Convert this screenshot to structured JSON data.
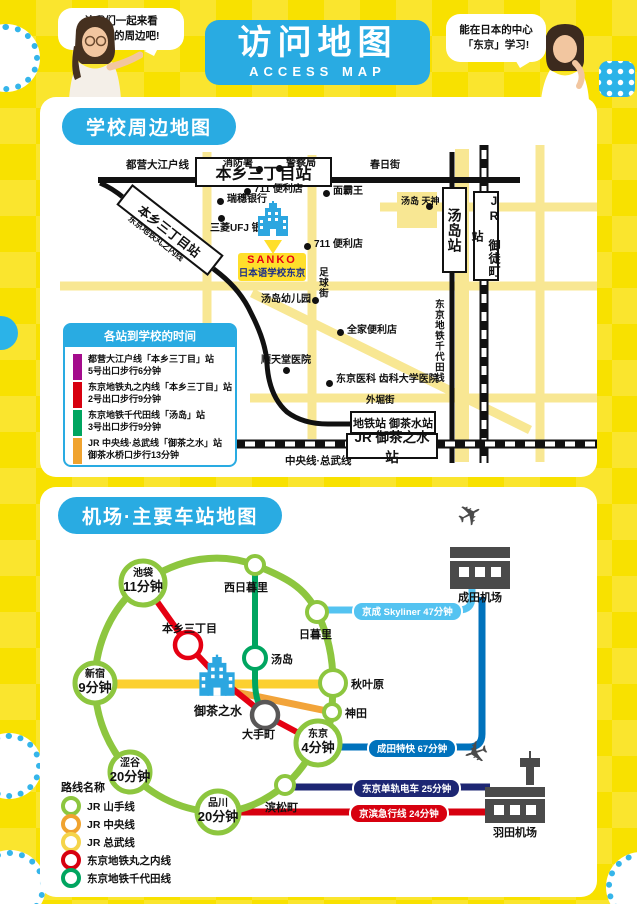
{
  "page": {
    "bg_color": "#f8e100",
    "accent_color": "#29abe2"
  },
  "header": {
    "title": "访问地图",
    "subtitle": "ACCESS MAP",
    "bubble_left": "让我们一起来看\n看学校的周边吧!",
    "bubble_right": "能在日本的中心\n「东京」学习!"
  },
  "section1": {
    "title": "学校周边地图",
    "lines": {
      "oedo": "都营大江户线",
      "marunouchi": "东京地铁丸之内线",
      "chiyoda": "东京地铁千代田线",
      "chuo_sobu": "中央线·总武线"
    },
    "streets": {
      "kasuga": "春日街",
      "soccer": "足球街",
      "sotobori": "外堀街"
    },
    "stations": {
      "hongo_box": "本乡三丁目站",
      "hongo_box_diag": "本乡三丁目站",
      "yushima_box": "汤岛站",
      "okachimachi_box": "JR 御徒町站",
      "metro_ochanomizu_box": "地铁站 御茶水站",
      "jr_ochanomizu_box": "JR 御茶之水站"
    },
    "pois": [
      {
        "label": "消防署"
      },
      {
        "label": "警察局"
      },
      {
        "label": "711 便利店"
      },
      {
        "label": "面霸王"
      },
      {
        "label": "瑞穗银行"
      },
      {
        "label": "三菱UFJ\n银行"
      },
      {
        "label": "汤岛\n天神"
      },
      {
        "label": "711 便利店"
      },
      {
        "label": "汤岛幼儿园"
      },
      {
        "label": "全家便利店"
      },
      {
        "label": "顺天堂医院"
      },
      {
        "label": "东京医科\n齿科大学医院"
      }
    ],
    "school": {
      "name": "SANKO",
      "subname": "日本语学校东京"
    },
    "legend": {
      "title": "各站到学校的时间",
      "rows": [
        {
          "color": "#a40b8c",
          "text": "都营大江户线「本乡三丁目」站\n5号出口步行6分钟"
        },
        {
          "color": "#d7000f",
          "text": "东京地铁丸之内线「本乡三丁目」站\n2号出口步行9分钟"
        },
        {
          "color": "#00a560",
          "text": "东京地铁千代田线「汤岛」站\n3号出口步行9分钟"
        },
        {
          "color": "#f0a32f",
          "text": "JR 中央线·总武线「御茶之水」站\n御茶水桥口步行13分钟"
        }
      ]
    }
  },
  "section2": {
    "title": "机场·主要车站地图",
    "big_stations": [
      {
        "name": "池袋",
        "time": "11分钟"
      },
      {
        "name": "新宿",
        "time": "9分钟"
      },
      {
        "name": "涩谷",
        "time": "20分钟"
      },
      {
        "name": "品川",
        "time": "20分钟"
      },
      {
        "name": "东京",
        "time": "4分钟"
      }
    ],
    "stations": {
      "nishinippori": "西日暮里",
      "nippori": "日暮里",
      "yushima": "汤岛",
      "akihabara": "秋叶原",
      "kanda": "神田",
      "hamamatsucho": "滨松町",
      "otemachi": "大手町",
      "hongo": "本乡三丁目",
      "ochanomizu": "御茶之水"
    },
    "routes": {
      "skyliner": {
        "label": "京成 Skyliner 47分钟",
        "color": "#54c3f1"
      },
      "nex": {
        "label": "成田特快 67分钟",
        "color": "#0072bc"
      },
      "monorail": {
        "label": "东京单轨电车 25分钟",
        "color": "#1d2673"
      },
      "keikyu": {
        "label": "京滨急行线 24分钟",
        "color": "#d7000f"
      }
    },
    "airports": {
      "narita": "成田机场",
      "haneda": "羽田机场"
    },
    "legend": {
      "title": "路线名称",
      "rows": [
        {
          "color": "#8dc63f",
          "label": "JR 山手线"
        },
        {
          "color": "#f0a32f",
          "label": "JR 中央线"
        },
        {
          "color": "#f5d44a",
          "label": "JR 总武线"
        },
        {
          "color": "#d7000f",
          "label": "东京地铁丸之内线"
        },
        {
          "color": "#00a560",
          "label": "东京地铁千代田线"
        }
      ]
    }
  }
}
